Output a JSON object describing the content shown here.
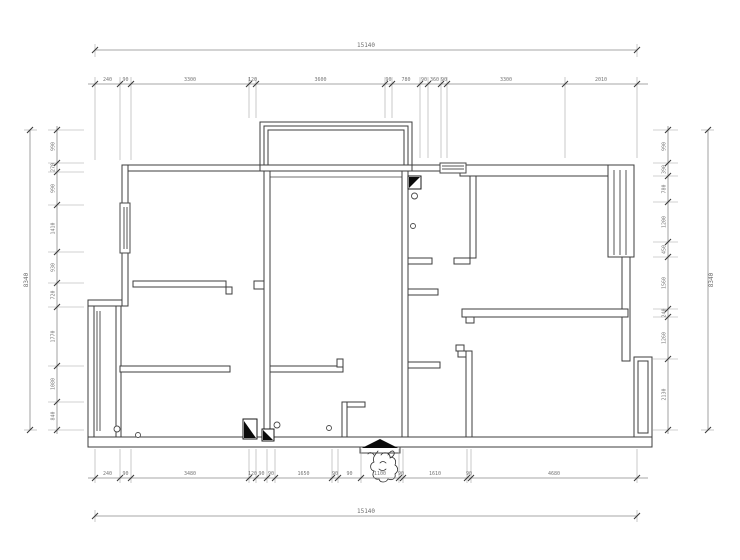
{
  "drawing": {
    "type": "apartment-floor-plan",
    "style": "CAD line drawing, dimension chains on all four sides"
  },
  "colors": {
    "background": "#ffffff",
    "wall_line": "#3d3d3d",
    "dimension_line": "#8a8a8a",
    "dimension_text": "#6e6e6e",
    "symbol_fill": "#0a0a0a"
  },
  "dimensions": {
    "top": {
      "overall": "15140",
      "segments": [
        "240",
        "90",
        "3300",
        "120",
        "3600",
        "90",
        "780",
        "90",
        "360",
        "90",
        "3300",
        "2010"
      ]
    },
    "bottom": {
      "overall": "15140",
      "segments": [
        "240",
        "90",
        "3480",
        "120",
        "90",
        "90",
        "1650",
        "90",
        "90",
        "1100",
        "90",
        "1610",
        "90",
        "4680"
      ]
    },
    "left": {
      "overall": "8340",
      "segments": [
        "990",
        "270",
        "990",
        "1410",
        "930",
        "720",
        "1770",
        "1080",
        "840"
      ]
    },
    "right": {
      "overall": "8340",
      "segments": [
        "990",
        "390",
        "780",
        "1200",
        "450",
        "1560",
        "240",
        "1260",
        "2130"
      ]
    }
  },
  "icons": {
    "entry_arrow": "filled-triangle-up",
    "entry_sketch": "hand-drawn-figure",
    "kitchen_corner_marker": "half-filled-square",
    "utility_marker_large": "half-filled-rect",
    "utility_marker_small": "half-filled-square-small",
    "door_pivot": "small-circle",
    "windows": "double-line-window",
    "balconies": "triple-line-bay-window"
  }
}
